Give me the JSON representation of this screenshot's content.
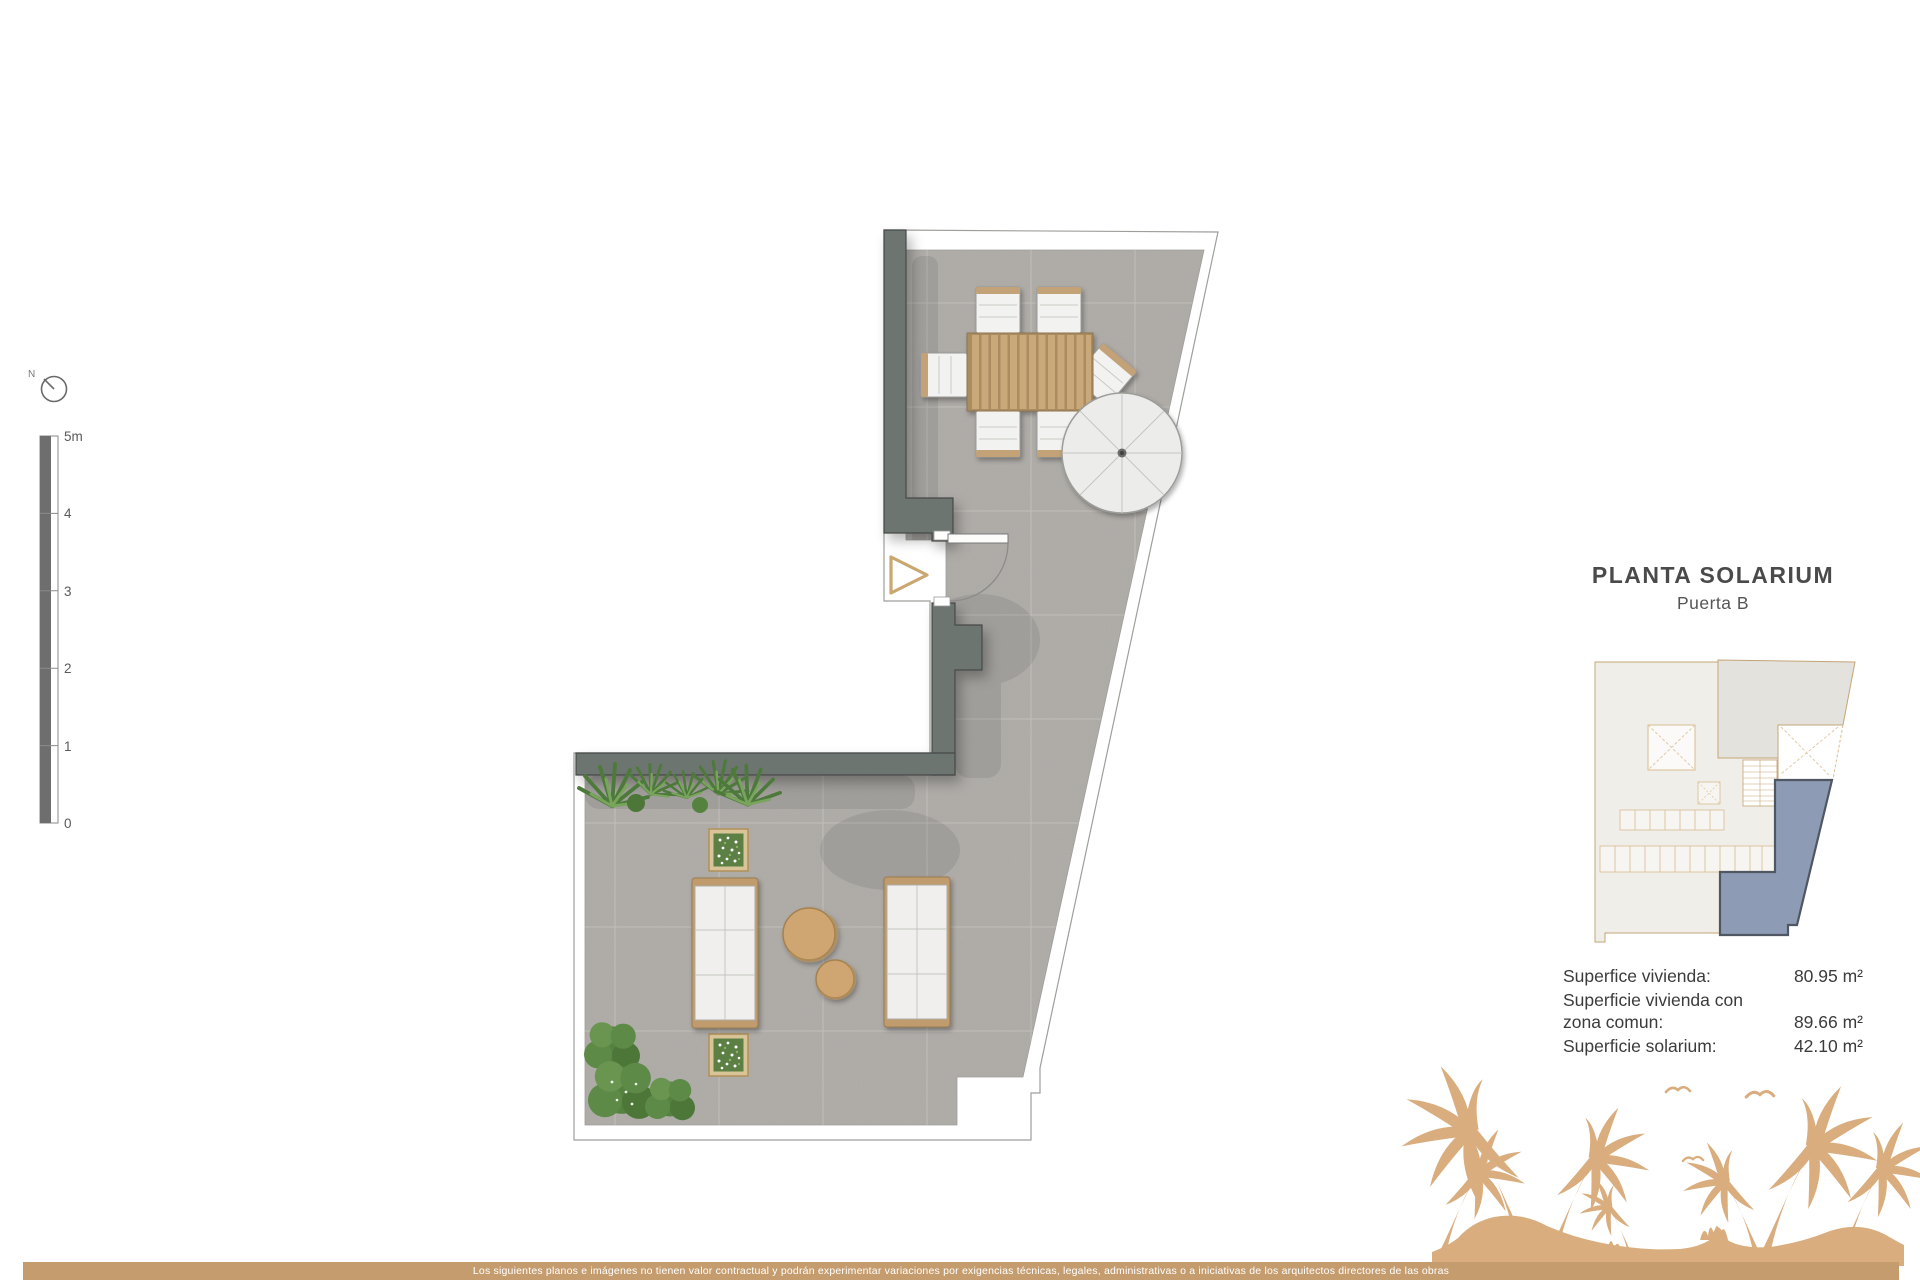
{
  "title_block": {
    "title": "PLANTA SOLARIUM",
    "subtitle": "Puerta B"
  },
  "areas": {
    "rows": [
      {
        "label": "Superfice vivienda:",
        "value": "80.95 m²"
      },
      {
        "label": "Superficie vivienda con zona comun:",
        "value": "89.66 m²"
      },
      {
        "label": "Superficie solarium:",
        "value": "42.10 m²"
      }
    ]
  },
  "scale_bar": {
    "ticks": [
      "5m",
      "4",
      "3",
      "2",
      "1",
      "0"
    ]
  },
  "compass": {
    "north_label": "N"
  },
  "footer": {
    "disclaimer": "Los siguientes planos e imágenes no tienen valor contractual y podrán experimentar variaciones por exigencias técnicas, legales, administrativas o a iniciativas de los arquitectos directores de las obras"
  },
  "icons": {
    "compass": "north-compass-icon",
    "entrance_arrow": "entrance-arrow-icon",
    "parasol": "parasol-icon"
  },
  "colors": {
    "accent_tan": "#c59c6e",
    "island_tan": "#d9ad7e",
    "unit_highlight": "#8d9bb4",
    "wall_gray": "#6d7571",
    "floor_gray": "#b4b1ac",
    "wood_tan": "#c8a578",
    "plant_green": "#5d8a47",
    "title_gray": "#4a4a4a"
  }
}
